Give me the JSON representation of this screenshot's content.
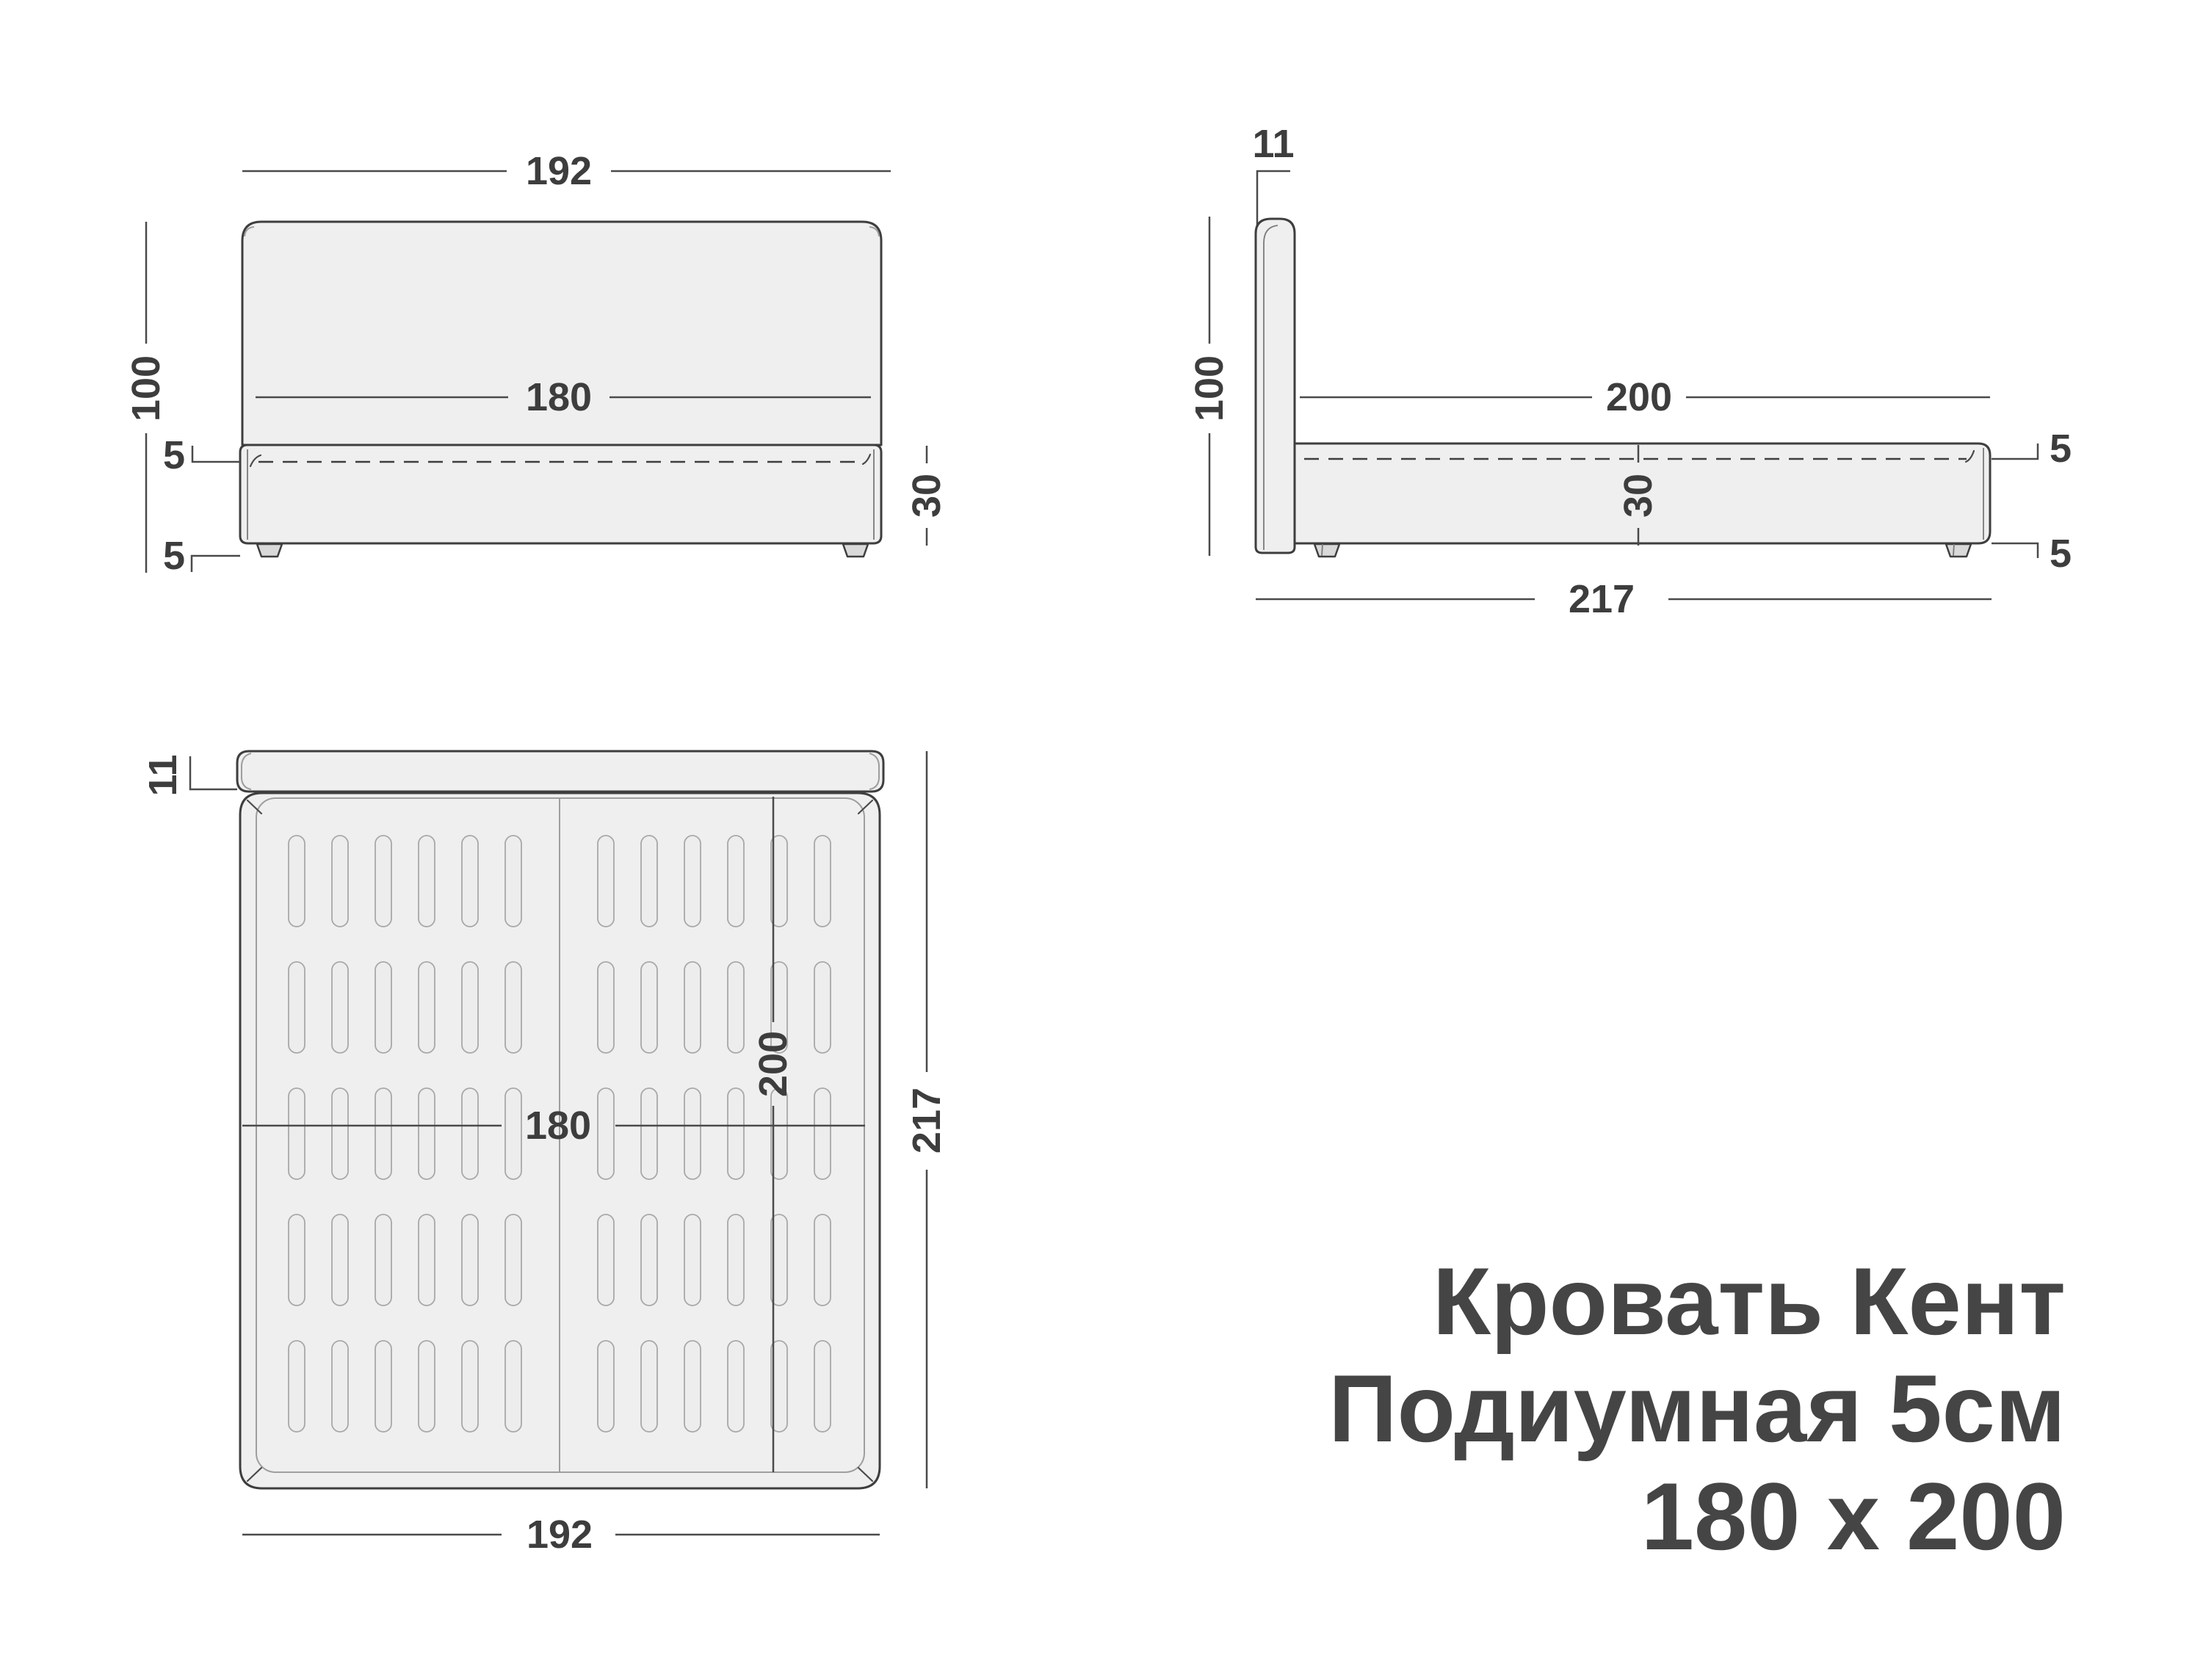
{
  "title": {
    "line1": "Кровать Кент",
    "line2": "Подиумная 5см",
    "line3": "180 х 200"
  },
  "front_view": {
    "overall_width": "192",
    "mattress_width": "180",
    "headboard_height": "100",
    "mattress_above_base": "5",
    "leg_height": "5",
    "base_height": "30"
  },
  "side_view": {
    "headboard_thickness": "11",
    "headboard_height": "100",
    "sleeping_length": "200",
    "base_height": "30",
    "mattress_above_base": "5",
    "leg_height": "5",
    "overall_length": "217"
  },
  "top_view": {
    "headboard_thickness": "11",
    "mattress_width": "180",
    "sleeping_length": "200",
    "overall_length": "217",
    "overall_width": "192"
  },
  "colors": {
    "outline": "#3e3e3e",
    "fill_light": "#efefef",
    "fill_foot": "#d9d9d9",
    "dimension_line": "#4a4a4a",
    "dimension_text": "#3d3d3d",
    "inner_line": "#9e9e9e",
    "title_text": "#454545",
    "background": "#ffffff"
  }
}
